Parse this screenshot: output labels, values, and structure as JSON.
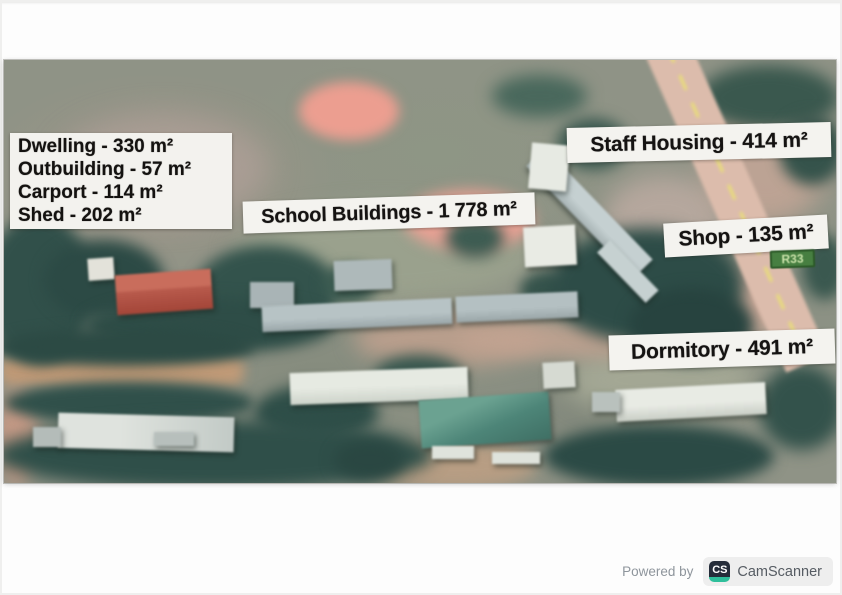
{
  "photo_labels": {
    "dwelling_group": {
      "lines": [
        "Dwelling - 330 m²",
        "Outbuilding - 57 m²",
        "Carport - 114 m²",
        "Shed - 202 m²"
      ]
    },
    "school": "School Buildings - 1 778 m²",
    "staff_housing": "Staff Housing - 414 m²",
    "shop": "Shop - 135 m²",
    "dormitory": "Dormitory - 491 m²",
    "road_sign": "R33"
  },
  "road_sign_colors": {
    "bg": "#477f41",
    "text": "#c9e2a9"
  },
  "watermark": {
    "powered_by": "Powered by",
    "brand": "CamScanner",
    "logo_text": "CS",
    "brand_navy": "#252d3a",
    "brand_teal": "#2fbf9b"
  }
}
